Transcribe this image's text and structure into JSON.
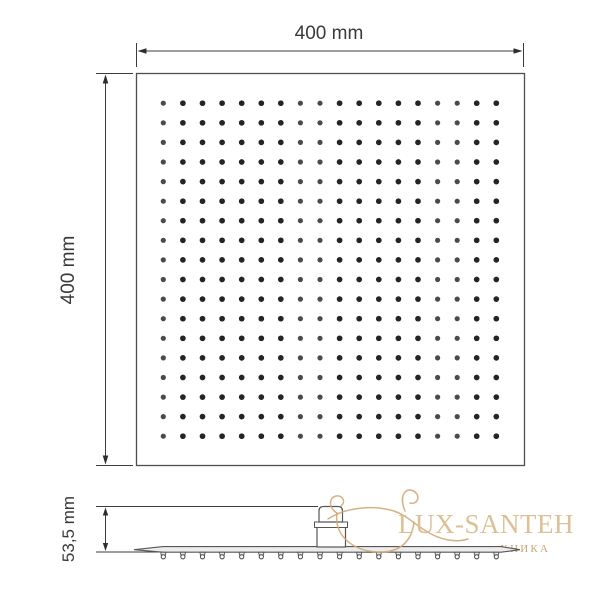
{
  "drawing": {
    "top_dimension_label": "400 mm",
    "left_dimension_label": "400 mm",
    "profile_dimension_label": "53,5 mm",
    "face_view": {
      "nozzle_rows": 18,
      "nozzle_cols": 18
    },
    "profile_view": {
      "nozzle_count": 18
    }
  },
  "watermark": {
    "brand_text": "LUX-SANTEH",
    "subtitle_visible_text": "ХНИКА",
    "brand_color": "#dcc197",
    "logo_color": "#d0a977",
    "logo": "bathtub-swirl-icon"
  },
  "colors": {
    "background": "#ffffff",
    "outline": "#4f4f4f",
    "dimension": "#3c3c3c",
    "nozzle_dot": "#242424",
    "nozzle_dot_light": "#4a4a4a"
  }
}
